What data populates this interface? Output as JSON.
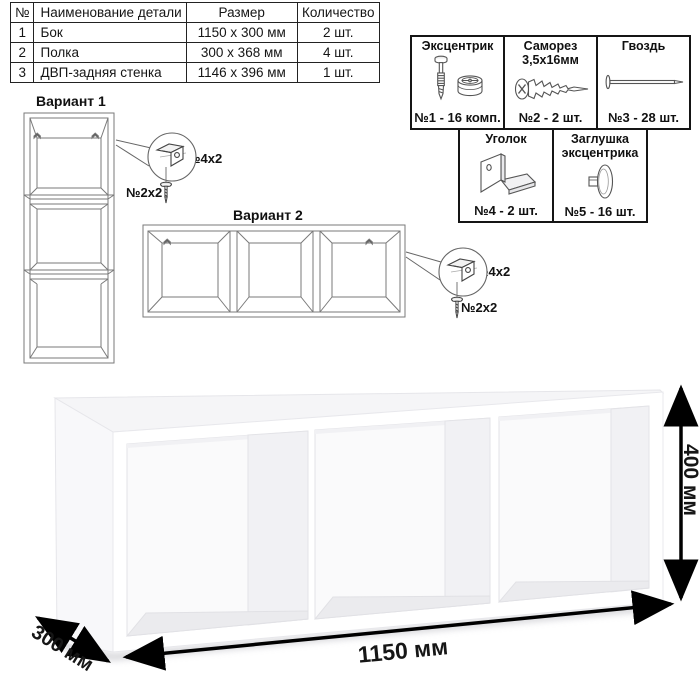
{
  "parts_table": {
    "headers": {
      "num": "№",
      "name": "Наименование детали",
      "size": "Размер",
      "qty": "Количество"
    },
    "rows": [
      {
        "num": "1",
        "name": "Бок",
        "size": "1150 x 300 мм",
        "qty": "2 шт."
      },
      {
        "num": "2",
        "name": "Полка",
        "size": "300 x 368 мм",
        "qty": "4 шт."
      },
      {
        "num": "3",
        "name": "ДВП-задняя стенка",
        "size": "1146 x 396 мм",
        "qty": "1 шт."
      }
    ]
  },
  "hardware": {
    "items": [
      {
        "title": "Эксцентрик",
        "caption": "№1 - 16 комп.",
        "icon": "cam-bolt-and-eccentric-icon"
      },
      {
        "title": "Саморез\n3,5х16мм",
        "caption": "№2 - 2 шт.",
        "icon": "screw-icon"
      },
      {
        "title": "Гвоздь",
        "caption": "№3 - 28 шт.",
        "icon": "nail-icon"
      },
      {
        "title": "Уголок",
        "caption": "№4 - 2 шт.",
        "icon": "corner-bracket-icon"
      },
      {
        "title": "Заглушка\nэксцентрика",
        "caption": "№5 - 16 шт.",
        "icon": "cam-cover-icon"
      }
    ]
  },
  "variants": {
    "variant1": {
      "title": "Вариант 1",
      "bracket_label": "№4х2",
      "screw_label": "№2х2"
    },
    "variant2": {
      "title": "Вариант 2",
      "bracket_label": "№4х2",
      "screw_label": "№2х2"
    }
  },
  "dimensions": {
    "width": "1150 мм",
    "depth": "300 мм",
    "height": "400 мм"
  },
  "colors": {
    "ink": "#111111",
    "drawing_line": "#777777"
  }
}
